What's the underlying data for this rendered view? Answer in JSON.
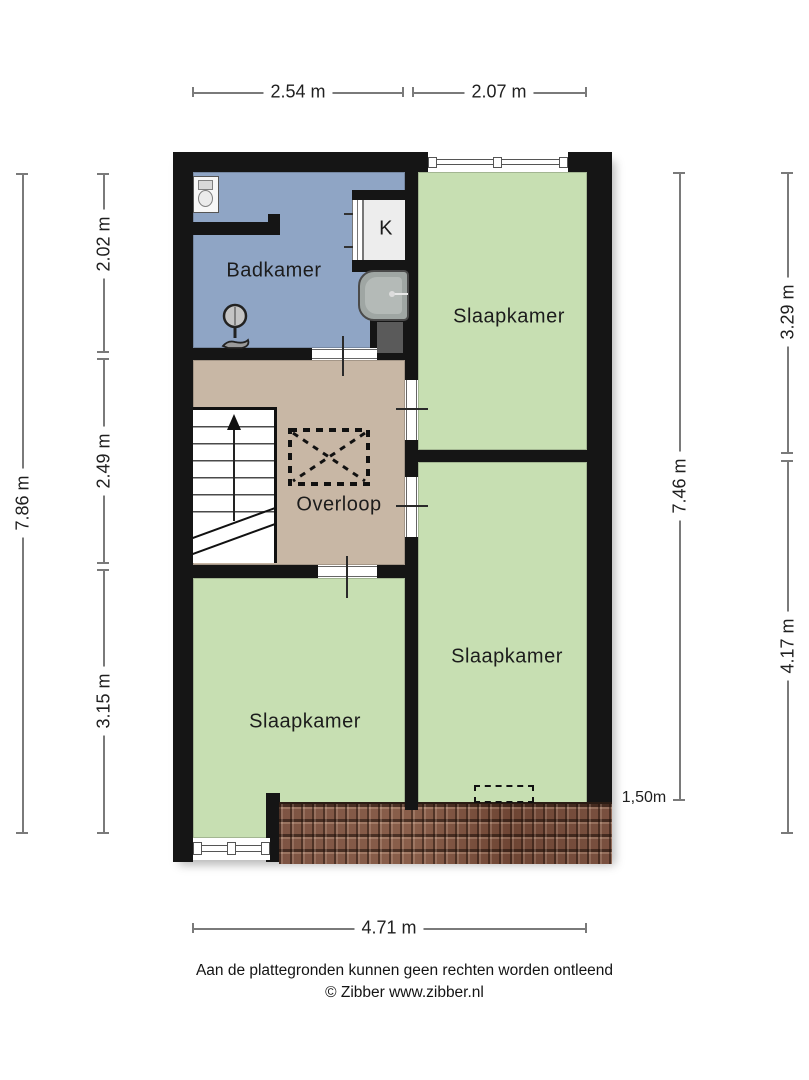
{
  "rooms": {
    "badkamer": {
      "label": "Badkamer"
    },
    "closet": {
      "label": "K"
    },
    "slaapkamer_top_right": {
      "label": "Slaapkamer"
    },
    "overloop": {
      "label": "Overloop"
    },
    "slaapkamer_bottom_right": {
      "label": "Slaapkamer"
    },
    "slaapkamer_bottom_left": {
      "label": "Slaapkamer"
    }
  },
  "dimensions": {
    "top_left_width": "2.54 m",
    "top_right_width": "2.07 m",
    "left_total_height": "7.86 m",
    "left_bathroom_height": "2.02 m",
    "left_landing_height": "2.49 m",
    "left_bedroom_height": "3.15 m",
    "right_inner_height": "7.46 m",
    "right_top_height": "3.29 m",
    "right_bottom_height": "4.17 m",
    "bottom_width": "4.71 m",
    "roof_depth": "1,50m"
  },
  "footer": {
    "disclaimer": "Aan de plattegronden kunnen geen rechten worden ontleend",
    "copyright": "© Zibber www.zibber.nl"
  },
  "colors": {
    "bathroom": "#8fa5c5",
    "bedroom": "#c7dfb2",
    "landing": "#c8b7a5",
    "wall": "#151515",
    "roof": "#7a5140"
  }
}
